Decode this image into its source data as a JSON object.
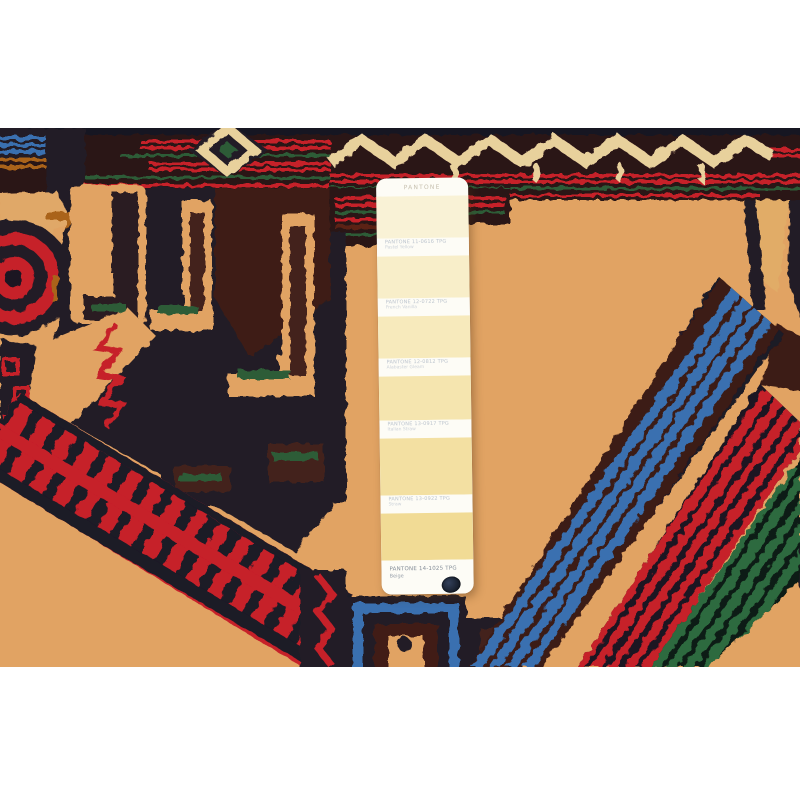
{
  "pantone_card": {
    "header": "PANTONE",
    "swatches": [
      "#f9f2d6",
      "#f8eec9",
      "#f7eabc",
      "#f5e5af",
      "#f3e0a2",
      "#f1db95"
    ],
    "labels": [
      {
        "code": "PANTONE 11-0616 TPG",
        "name": "Pastel Yellow"
      },
      {
        "code": "PANTONE 12-0722 TPG",
        "name": "French Vanilla"
      },
      {
        "code": "PANTONE 12-0812 TPG",
        "name": "Alabaster Gleam"
      },
      {
        "code": "PANTONE 13-0917 TPG",
        "name": "Italian Straw"
      },
      {
        "code": "PANTONE 13-0922 TPG",
        "name": "Straw"
      }
    ],
    "footer": {
      "code": "PANTONE 14-1025 TPG",
      "name": "Beige"
    }
  },
  "rug_palette": {
    "field_tan": "#dfa365",
    "navy": "#241b26",
    "maroon": "#3f1d16",
    "red": "#c2202c",
    "green": "#2d5c38",
    "blue": "#3a6fae",
    "cream": "#e7d19e",
    "orange": "#a8641f"
  }
}
